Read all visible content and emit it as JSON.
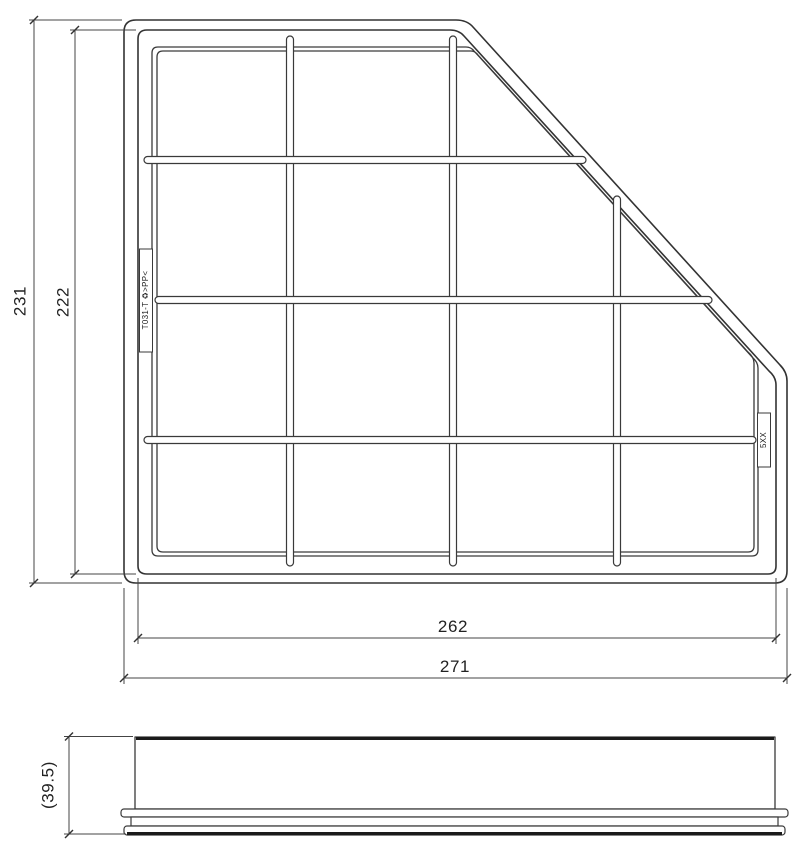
{
  "page": {
    "background": "#ffffff",
    "line_color": "#333333",
    "description": "engineering-drawing-air-filter"
  },
  "top_view": {
    "dims": {
      "outer_height": "231",
      "body_height": "222",
      "body_width": "262",
      "outer_width": "271"
    },
    "molded_labels": {
      "left": "T031-T ♻>PP<",
      "right": "5XX"
    }
  },
  "side_view": {
    "dims": {
      "overall_height": "(39.5)"
    }
  }
}
